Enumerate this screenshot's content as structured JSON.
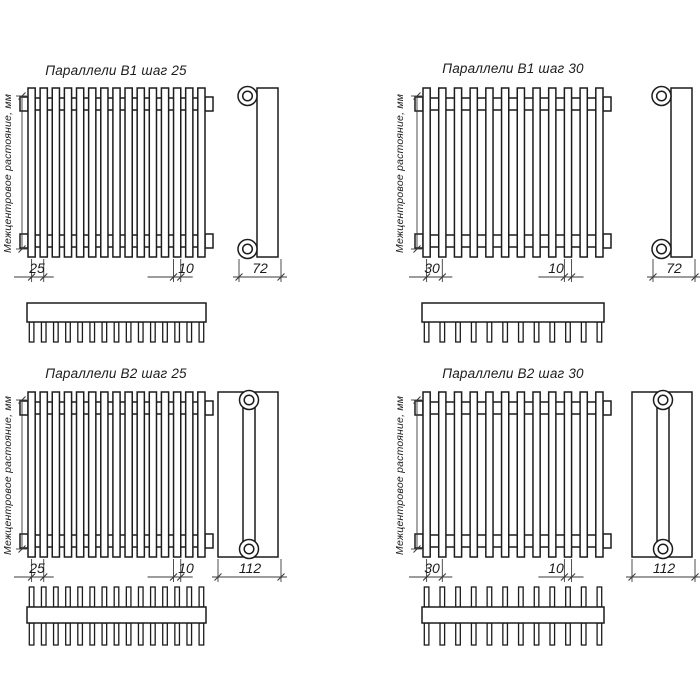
{
  "colors": {
    "background": "#ffffff",
    "contour_line": "#1c1c1c",
    "dimension_line": "#3a3a3a"
  },
  "axis_label": "Межцентровое растояние, мм",
  "panels": [
    {
      "title": "Параллели В1 шаг 25",
      "model": "В1",
      "step": "25",
      "tube_dim": "10",
      "depth": "72",
      "tube_count": 15,
      "tube_rows": 1
    },
    {
      "title": "Параллели В1 шаг 30",
      "model": "В1",
      "step": "30",
      "tube_dim": "10",
      "depth": "72",
      "tube_count": 12,
      "tube_rows": 1
    },
    {
      "title": "Параллели В2 шаг 25",
      "model": "В2",
      "step": "25",
      "tube_dim": "10",
      "depth": "112",
      "tube_count": 15,
      "tube_rows": 2
    },
    {
      "title": "Параллели В2 шаг 30",
      "model": "В2",
      "step": "30",
      "tube_dim": "10",
      "depth": "112",
      "tube_count": 12,
      "tube_rows": 2
    }
  ]
}
